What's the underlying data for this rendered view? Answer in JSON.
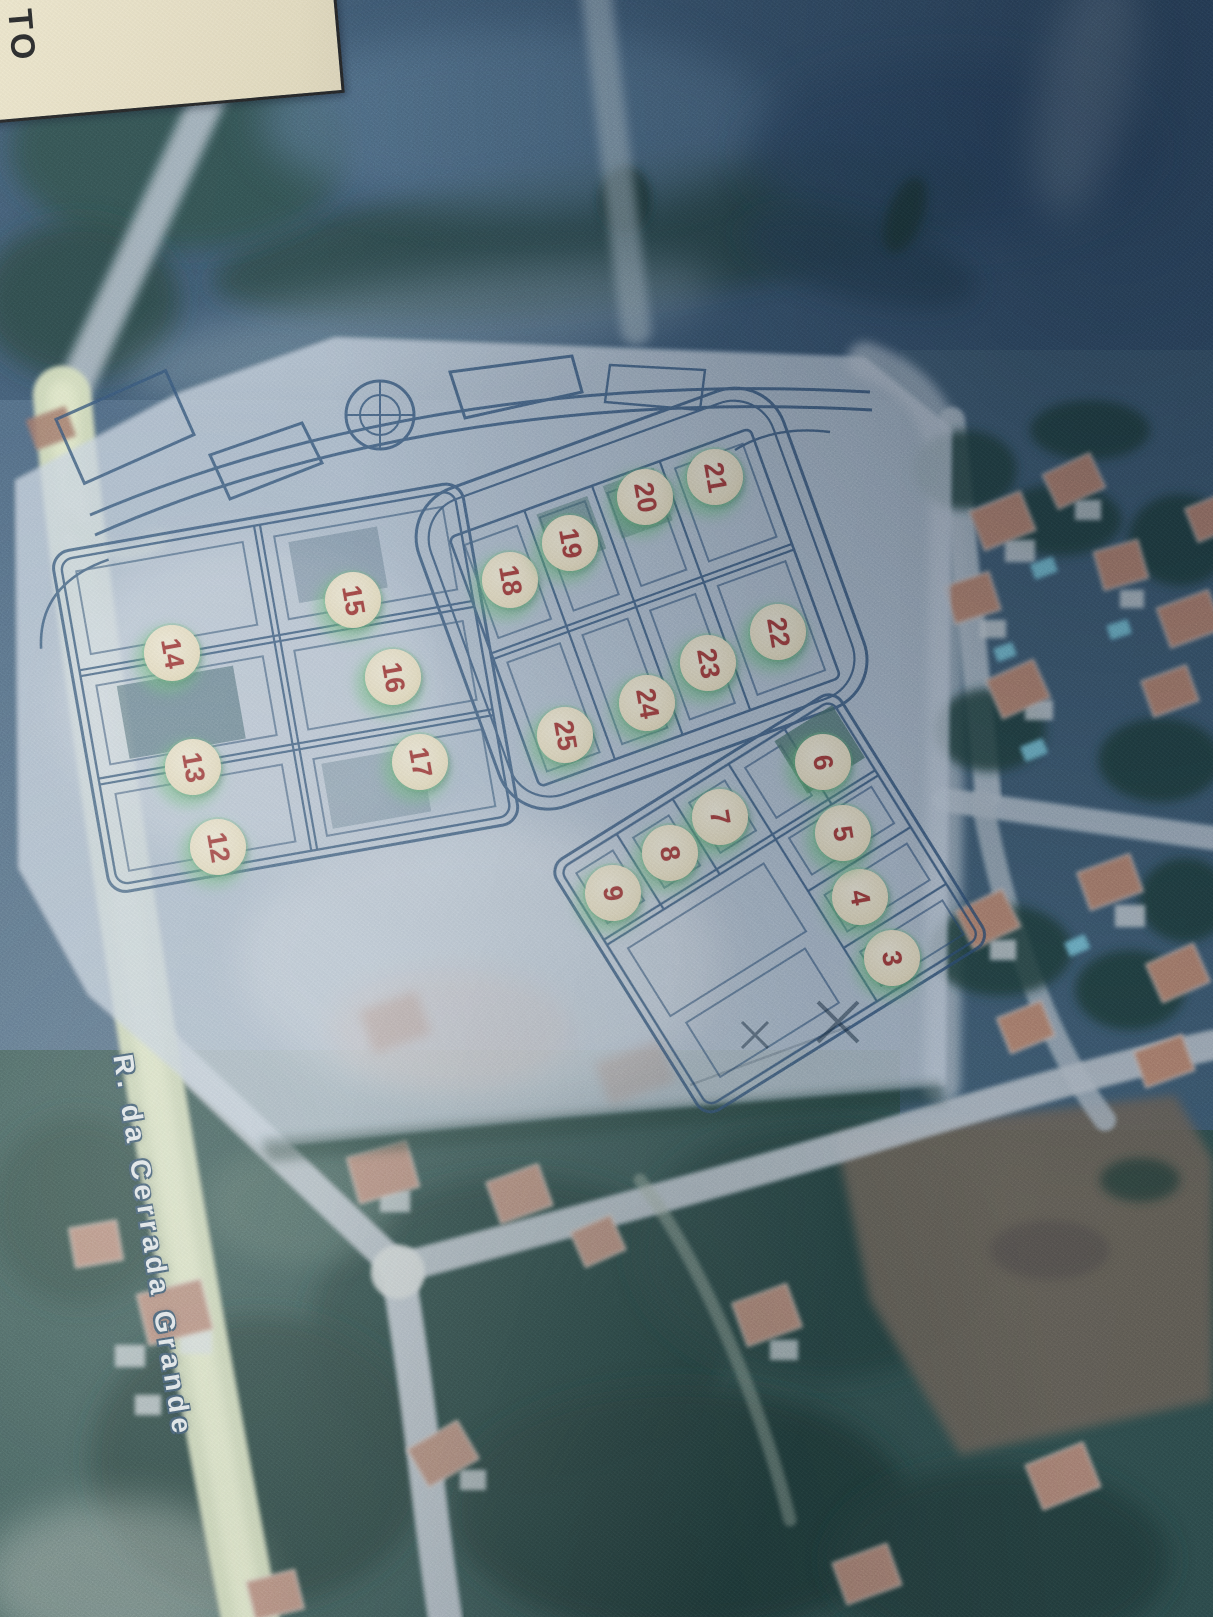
{
  "map": {
    "description": "Photograph of a printed aerial photo with a translucent lot-plan overlay and numbered plot stickers",
    "street_label": "R. da Cerrada Grande",
    "corner_label_fragment": "TO",
    "markers": [
      {
        "label": "3",
        "x": 892,
        "y": 958
      },
      {
        "label": "4",
        "x": 860,
        "y": 897
      },
      {
        "label": "5",
        "x": 843,
        "y": 833
      },
      {
        "label": "6",
        "x": 823,
        "y": 762
      },
      {
        "label": "7",
        "x": 720,
        "y": 817
      },
      {
        "label": "8",
        "x": 670,
        "y": 853
      },
      {
        "label": "9",
        "x": 613,
        "y": 893
      },
      {
        "label": "12",
        "x": 218,
        "y": 847
      },
      {
        "label": "13",
        "x": 193,
        "y": 767
      },
      {
        "label": "14",
        "x": 172,
        "y": 653
      },
      {
        "label": "15",
        "x": 353,
        "y": 600
      },
      {
        "label": "16",
        "x": 393,
        "y": 677
      },
      {
        "label": "17",
        "x": 420,
        "y": 762
      },
      {
        "label": "18",
        "x": 510,
        "y": 580
      },
      {
        "label": "19",
        "x": 570,
        "y": 543
      },
      {
        "label": "20",
        "x": 645,
        "y": 497
      },
      {
        "label": "21",
        "x": 715,
        "y": 477
      },
      {
        "label": "22",
        "x": 778,
        "y": 632
      },
      {
        "label": "23",
        "x": 708,
        "y": 663
      },
      {
        "label": "24",
        "x": 647,
        "y": 703
      },
      {
        "label": "25",
        "x": 565,
        "y": 735
      }
    ],
    "colors": {
      "marker_fill": "#eee3c2",
      "marker_number": "#a23531",
      "marker_halo": "#60be70",
      "plan_line": "#2b4d73",
      "plan_sheet": "#cdd9e6",
      "road_highlight": "#d9e3bd",
      "aerial_road": "#b9c6d2",
      "vegetation_dark": "#1d3a34",
      "roof_salmon": "#c18a70",
      "pool_cyan": "#7fcfe3",
      "field_brown": "#6f6557"
    }
  }
}
